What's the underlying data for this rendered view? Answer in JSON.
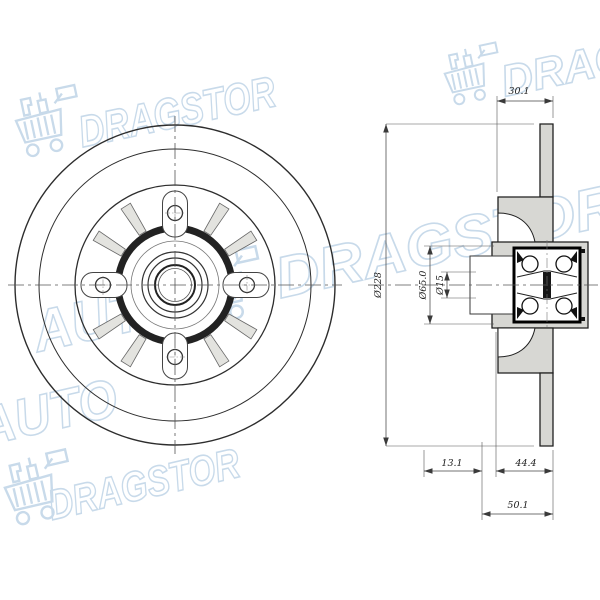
{
  "watermark": {
    "brand_first": "AUTO",
    "brand_second": "DRAGSTOR",
    "cart_icon": "shopping-cart-icon",
    "color": "#c8daea"
  },
  "drawing": {
    "line_color": "#2d2d2d",
    "section_fill": "#d7d7d3",
    "dimensions": {
      "top_width": "30.1",
      "outer_diameter": "Ø228",
      "flange_diameter": "Ø65.0",
      "pilot_diameter": "Ø15",
      "left_offset": "13.1",
      "hub_height": "44.4",
      "total_height": "50.1"
    }
  }
}
